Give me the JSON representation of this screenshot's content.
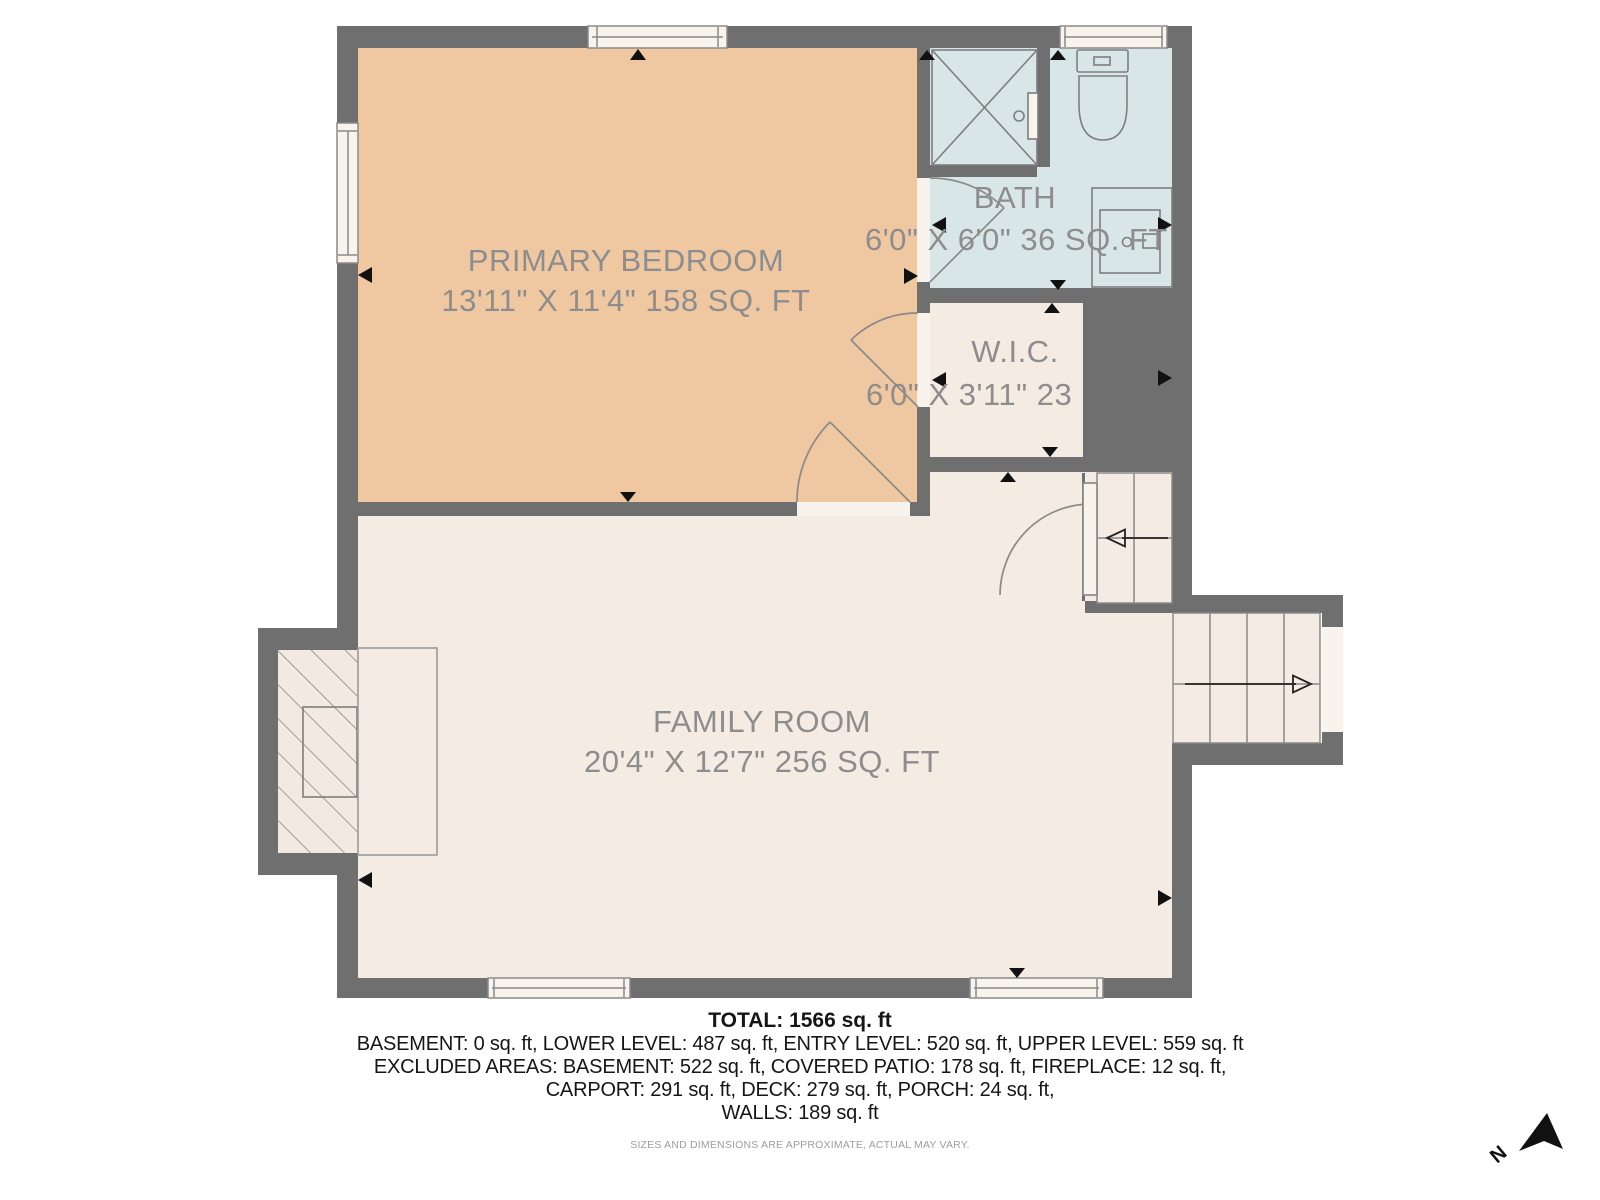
{
  "floor_plan": {
    "rooms": [
      {
        "name": "PRIMARY BEDROOM",
        "dims": "13'11\" X 11'4\" 158 SQ. FT",
        "fill": "#efc8a2"
      },
      {
        "name": "BATH",
        "dims": "6'0\" X 6'0\" 36 SQ. FT",
        "fill": "#d9e6e8"
      },
      {
        "name": "W.I.C.",
        "dims": "6'0\" X 3'11\" 23 SQ. FT",
        "fill": "#f4ebe3"
      },
      {
        "name": "FAMILY ROOM",
        "dims": "20'4\" X 12'7\" 256 SQ. FT",
        "fill": "#f4ebe3"
      }
    ],
    "fixtures": [
      "shower",
      "toilet",
      "vanity-sink",
      "fireplace",
      "stairs-up",
      "stairs-down",
      "windows",
      "doors"
    ]
  },
  "summary": {
    "total": "TOTAL: 1566 sq. ft",
    "levels": "BASEMENT: 0 sq. ft, LOWER LEVEL: 487 sq. ft, ENTRY LEVEL: 520 sq. ft, UPPER LEVEL: 559 sq. ft",
    "excluded_1": "EXCLUDED AREAS: BASEMENT: 522 sq. ft, COVERED PATIO: 178 sq. ft, FIREPLACE: 12 sq. ft,",
    "excluded_2": "CARPORT: 291 sq. ft, DECK: 279 sq. ft, PORCH: 24 sq. ft,",
    "excluded_3": "WALLS: 189 sq. ft"
  },
  "disclaimer": "SIZES AND DIMENSIONS ARE APPROXIMATE, ACTUAL MAY VARY.",
  "compass": {
    "north_label": "N"
  },
  "colors": {
    "wall": "#6f6f6f",
    "bedroom_fill": "#efc8a2",
    "bath_fill": "#d9e6e8",
    "room_fill": "#f4ebe3",
    "opening_fill": "#f8f3ec",
    "label_text": "#8d8d8d",
    "footer_text": "#161616",
    "disclaimer_text": "#9e9e9e",
    "marker": "#111111"
  }
}
